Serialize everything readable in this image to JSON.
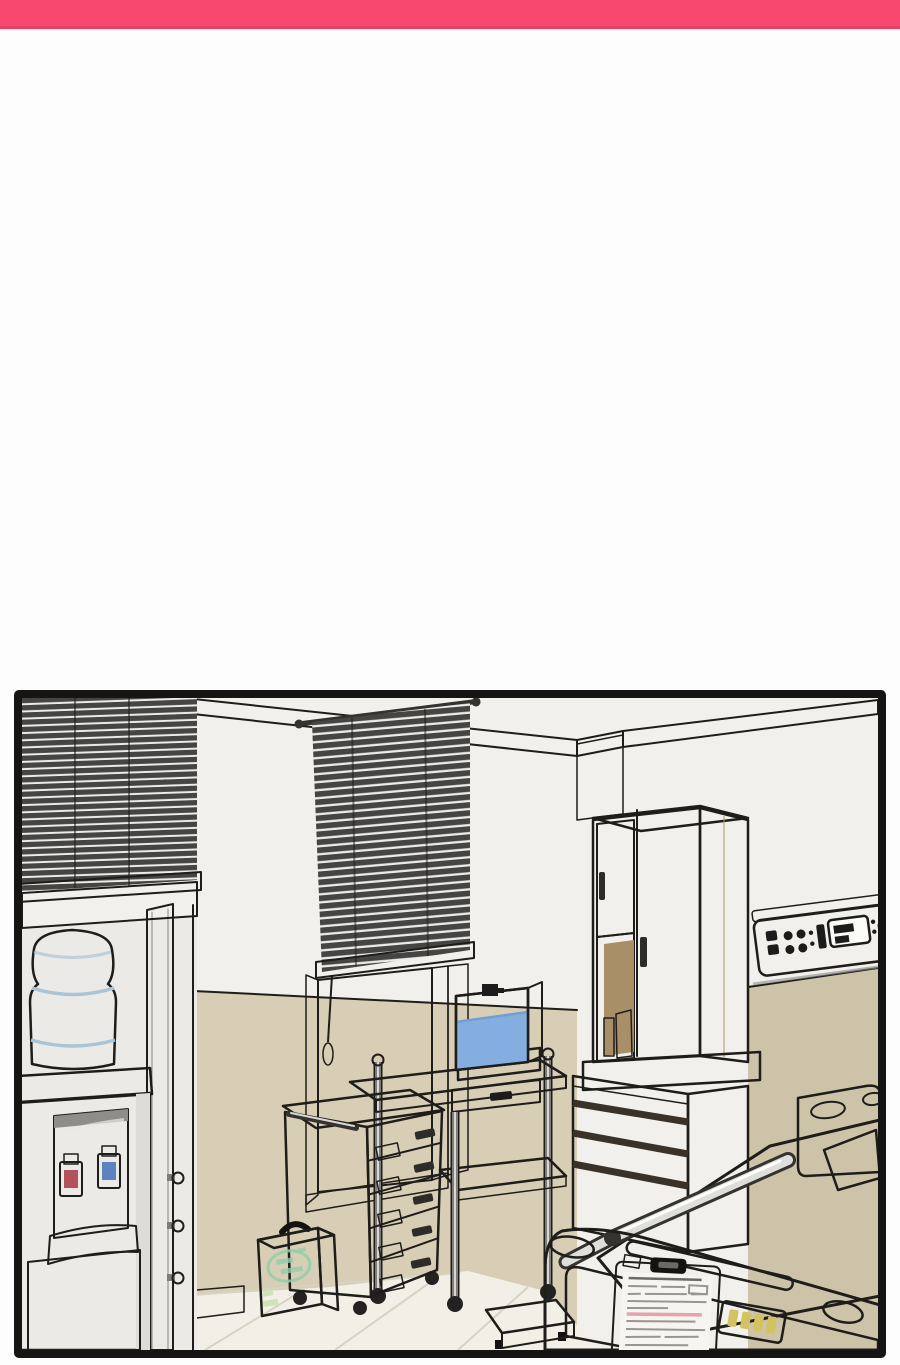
{
  "meta": {
    "kind": "webtoon comic panel",
    "scene_label": "hospital room interior illustration",
    "text_legible": false,
    "notes": "patient chart, first-aid emblem and bed LCD contain only illegible scribble marks"
  },
  "colors": {
    "pageBg": "#fdfdfd",
    "topBar": "#f9486f",
    "topBarEdge": "#ee3d64",
    "panelBorder": "#171513",
    "line": "#1f1d1a",
    "wall": "#f1f0ec",
    "wallShade": "#e7e6e1",
    "molding": "#d0c3a2",
    "moldingDark": "#c1b190",
    "wainscotL": "#d7ceb5",
    "wainscotR": "#ccc3a9",
    "baseTan": "#c9bfa4",
    "floor": "#f2efe6",
    "floorLine": "#d7d2c3",
    "blindDark": "#454543",
    "blindLight": "#ecebe9",
    "blindRail": "#4a4947",
    "glass": "#d7d6d2",
    "frameLight": "#eceae6",
    "frameGray": "#8f8d88",
    "pillarWhite": "#f1f0ec",
    "bottle": "#cfe0ea",
    "bottleShade": "#a9c4d6",
    "cooler": "#f3f2ef",
    "coolerShade": "#dddcd7",
    "coolerTop": "#636360",
    "coolerPanel": "#c7c6c2",
    "coolerBand": "#55544f",
    "tapHot": "#8e3038",
    "tapHotLight": "#b6505a",
    "tapCold": "#3a5f9e",
    "tapColdLight": "#5c82c0",
    "doorWhite": "#f6f5f1",
    "cabTop": "#c9c7c2",
    "wood": "#c6b18d",
    "woodLight": "#d8c9ab",
    "woodDark": "#b19a75",
    "woodGap": "#3a3228",
    "cubby": "#8d7757",
    "cubbyBack": "#a98f68",
    "bottleGreen": "#5d8f82",
    "panelBody": "#fbfbf8",
    "panelGreen": "#a9c7ae",
    "btn": "#1c1c1c",
    "metalLight": "#e9e8e4",
    "metalMid": "#dddcd7",
    "metalPole": "#7e7d79",
    "poleHi": "#d8d7d3",
    "water": "#85aee0",
    "waterLight": "#c8daf0",
    "waterSide": "#6f9fd4",
    "tankBase": "#6f6e6a",
    "cart": "#efeeea",
    "cartFace": "#ebeae5",
    "handleDark": "#2e2c28",
    "green1": "#166944",
    "green2": "#0e4d33",
    "green3": "#2a7d52",
    "emblem": "#8fcfa8",
    "kitMark": "#cfe3b8",
    "bedWhite": "#f8f7f3",
    "bedTan": "#c9b291",
    "cutout": "#d2d1cc",
    "headboard": "#dddcd8",
    "pillow": "#fcfbf8",
    "railDark": "#35332f",
    "railBody": "#dededa",
    "clipboard": "#232220",
    "clip": "#141311",
    "paper": "#f6f5f1",
    "scribble": "#98968f",
    "scribbleDark": "#6b6a66",
    "scribblePink": "#e5a3ab",
    "lcd": "#bdd3ea",
    "lcdDigit": "#d2c35e",
    "platform": "#54534e",
    "platformSide": "#7b7a75",
    "wheel": "#232220",
    "knob": "#c9c8c4"
  },
  "objects": {
    "panel": {
      "label": "comic panel: hospital room"
    },
    "blindLeft": {
      "label": "venetian blind (left window)"
    },
    "blindCenter": {
      "label": "venetian blind (center window)"
    },
    "windowCenter": {
      "label": "window"
    },
    "waterDispenser": {
      "label": "water dispenser with blue bottle, hot and cold taps"
    },
    "hookPillar": {
      "label": "door frame pillar with hooks"
    },
    "wardrobe": {
      "label": "wardrobe cabinet with open cubby"
    },
    "drawerChest": {
      "label": "wooden drawer chest"
    },
    "controlPanel": {
      "label": "wall-mounted bedside control panel"
    },
    "fishTank": {
      "label": "small aquarium on trolley"
    },
    "trolley": {
      "label": "stainless instrument trolley"
    },
    "medicineCart": {
      "label": "white 5-drawer medicine cart"
    },
    "firstAidKit": {
      "label": "green first aid kit (illegible emblem text)"
    },
    "bed": {
      "label": "hospital bed with footboard, chart clipboard and LCD"
    },
    "clipboardChart": {
      "label": "patient chart clipboard (illegible handwriting)"
    },
    "lcdDisplay": {
      "label": "bed LCD display (illegible digits)"
    },
    "stepPlatform": {
      "label": "dark step platform / scale"
    },
    "floor": {
      "label": "tiled floor"
    }
  }
}
